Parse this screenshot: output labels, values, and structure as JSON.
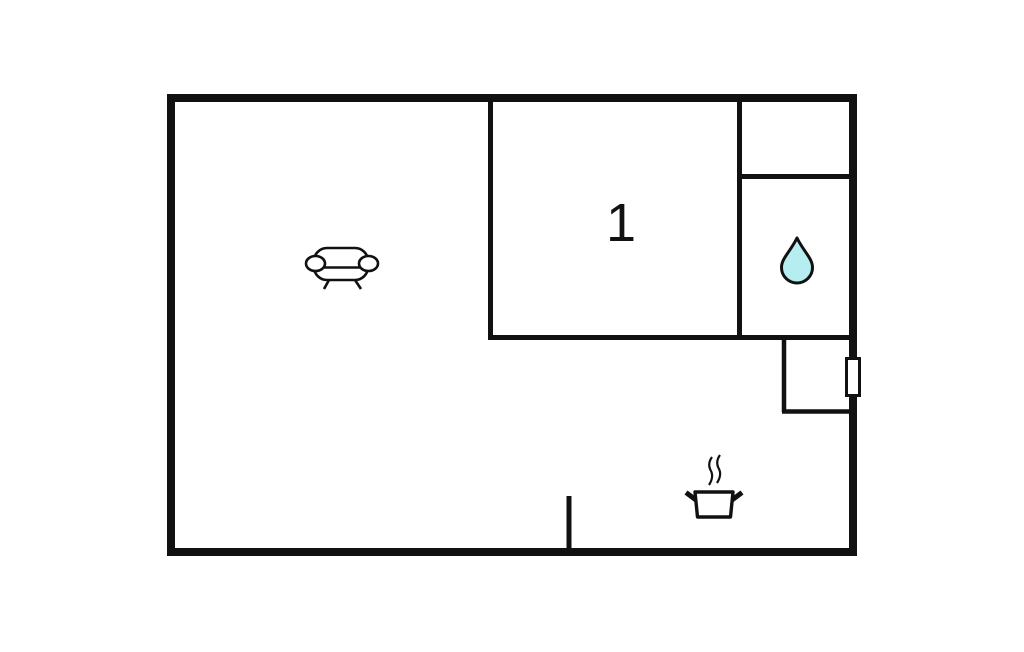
{
  "floorplan": {
    "room_label": "1",
    "wall_color": "#111111",
    "background_color": "#ffffff",
    "water_drop_color": "#b6edf0",
    "window_fill_color": "#ffffff",
    "icons": {
      "sofa": "sofa-icon",
      "water_drop": "water-drop-icon",
      "cooking_pot": "cooking-pot-icon",
      "window": "window-marker"
    }
  }
}
